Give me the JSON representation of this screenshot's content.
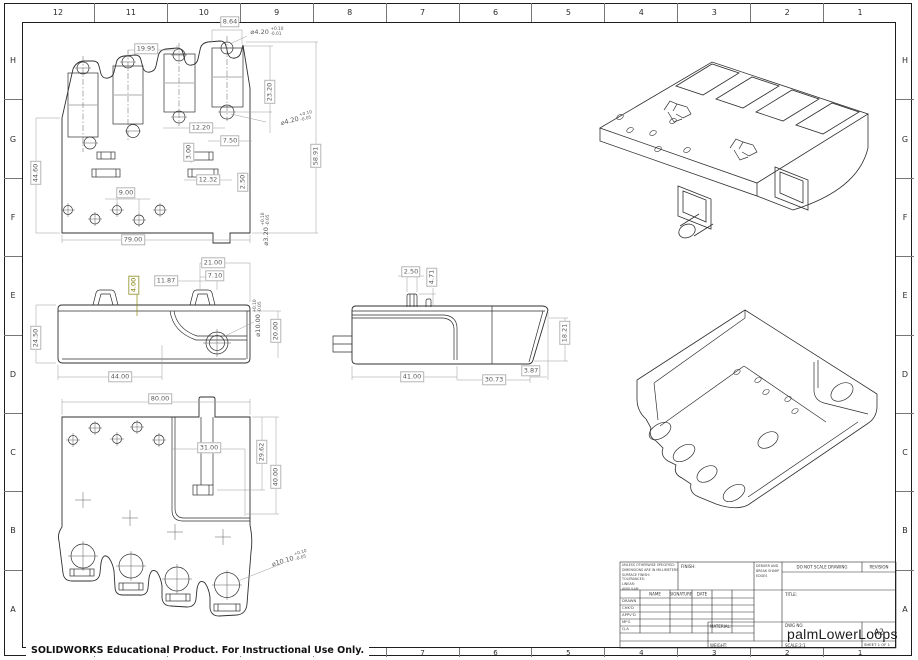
{
  "sheet": {
    "zone_columns": [
      "12",
      "11",
      "10",
      "9",
      "8",
      "7",
      "6",
      "5",
      "4",
      "3",
      "2",
      "1"
    ],
    "zone_rows": [
      "H",
      "G",
      "F",
      "E",
      "D",
      "C",
      "B",
      "A"
    ],
    "footer_note": "SOLIDWORKS Educational Product. For Instructional Use Only."
  },
  "title_block": {
    "spec_lines": [
      "UNLESS OTHERWISE SPECIFIED:",
      "DIMENSIONS ARE IN MILLIMETERS",
      "SURFACE FINISH:",
      "TOLERANCES:",
      "   LINEAR:",
      "   ANGULAR:"
    ],
    "finish_label": "FINISH:",
    "deburr_lines": [
      "DEBURR AND",
      "BREAK SHARP",
      "EDGES"
    ],
    "do_not_scale": "DO NOT SCALE DRAWING",
    "revision_label": "REVISION",
    "sig_headers": [
      "NAME",
      "SIGNATURE",
      "DATE"
    ],
    "sig_rows": [
      "DRAWN",
      "CHK'D",
      "APPV'D",
      "MFG",
      "Q.A"
    ],
    "title_label": "TITLE:",
    "material_label": "MATERIAL:",
    "weight_label": "WEIGHT:",
    "dwg_label": "DWG NO.",
    "dwg_value": "palmLowerLoops",
    "paper_size": "A2",
    "scale_label": "SCALE:2:1",
    "sheet_label": "SHEET 1 OF 1"
  },
  "dims": {
    "top": {
      "w19_95": "19.95",
      "w8_64": "8.64",
      "hole_top": {
        "d": "⌀4.20",
        "p": "+0.10",
        "m": "-0.01"
      },
      "h23_20": "23.20",
      "w12_20": "12.20",
      "hole_mid": {
        "d": "⌀4.20",
        "p": "+0.10",
        "m": "-0.05"
      },
      "w7_50": "7.50",
      "h3_00": "3.00",
      "w12_32": "12.32",
      "h2_50": "2.50",
      "w9_00": "9.00",
      "h44_60": "44.60",
      "h58_91": "58.91",
      "w79_00": "79.00",
      "hole_bot": {
        "d": "⌀3.20",
        "p": "+0.10",
        "m": "-0.05"
      }
    },
    "front": {
      "w21_00": "21.00",
      "w7_10": "7.10",
      "w11_87": "11.87",
      "h4_00": "4.00",
      "h24_50": "24.50",
      "hole": {
        "d": "⌀10.00",
        "p": "+0.10",
        "m": "-0.05"
      },
      "h20_00": "20.00",
      "w44_00": "44.00"
    },
    "side": {
      "w2_50": "2.50",
      "h4_71": "4.71",
      "w41_00": "41.00",
      "w30_73": "30.73",
      "w3_87": "3.87",
      "h18_21": "18.21"
    },
    "bottom": {
      "w80_00": "80.00",
      "w31_00": "31.00",
      "h29_62": "29.62",
      "h40_00": "40.00",
      "hole": {
        "d": "⌀10.10",
        "p": "+0.10",
        "m": "-0.05"
      }
    }
  }
}
